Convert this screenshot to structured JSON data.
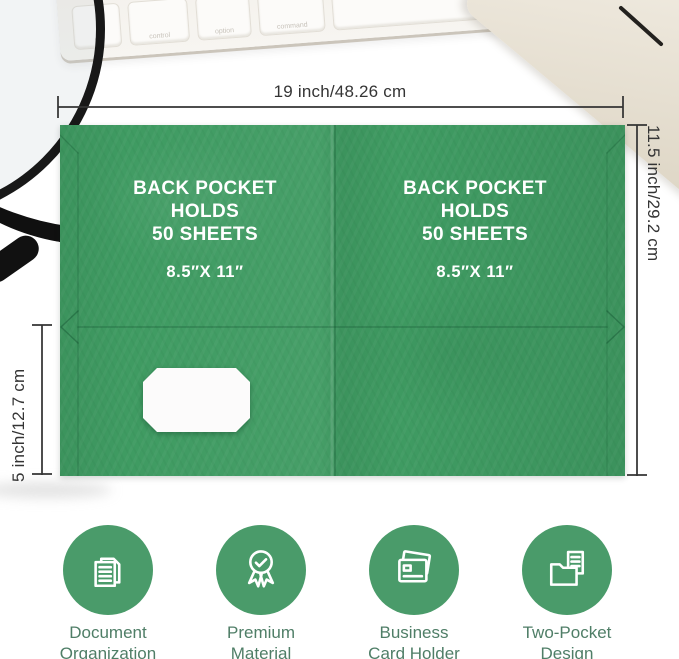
{
  "colors": {
    "folder_green": "#3f9b62",
    "icon_circle_green": "#4a9b6a",
    "feature_label_green": "#4f7e67",
    "dimension_text": "#343434",
    "panel_text": "#ffffff"
  },
  "dimensions": {
    "top": "19 inch/48.26 cm",
    "right": "11.5 inch/29.2 cm",
    "left": "5 inch/12.7 cm"
  },
  "folder": {
    "left_panel": {
      "line1": "BACK POCKET",
      "line2": "HOLDS",
      "line3": "50 SHEETS",
      "size": "8.5″X 11″"
    },
    "right_panel": {
      "line1": "BACK POCKET",
      "line2": "HOLDS",
      "line3": "50 SHEETS",
      "size": "8.5″X 11″"
    }
  },
  "keyboard": {
    "keys": [
      "fn",
      "control",
      "option",
      "command"
    ]
  },
  "features": [
    {
      "icon": "documents-icon",
      "label_line1": "Document",
      "label_line2": "Organization"
    },
    {
      "icon": "award-icon",
      "label_line1": "Premium",
      "label_line2": "Material"
    },
    {
      "icon": "card-holder-icon",
      "label_line1": "Business",
      "label_line2": "Card Holder"
    },
    {
      "icon": "two-pocket-folder-icon",
      "label_line1": "Two-Pocket",
      "label_line2": "Design"
    }
  ]
}
